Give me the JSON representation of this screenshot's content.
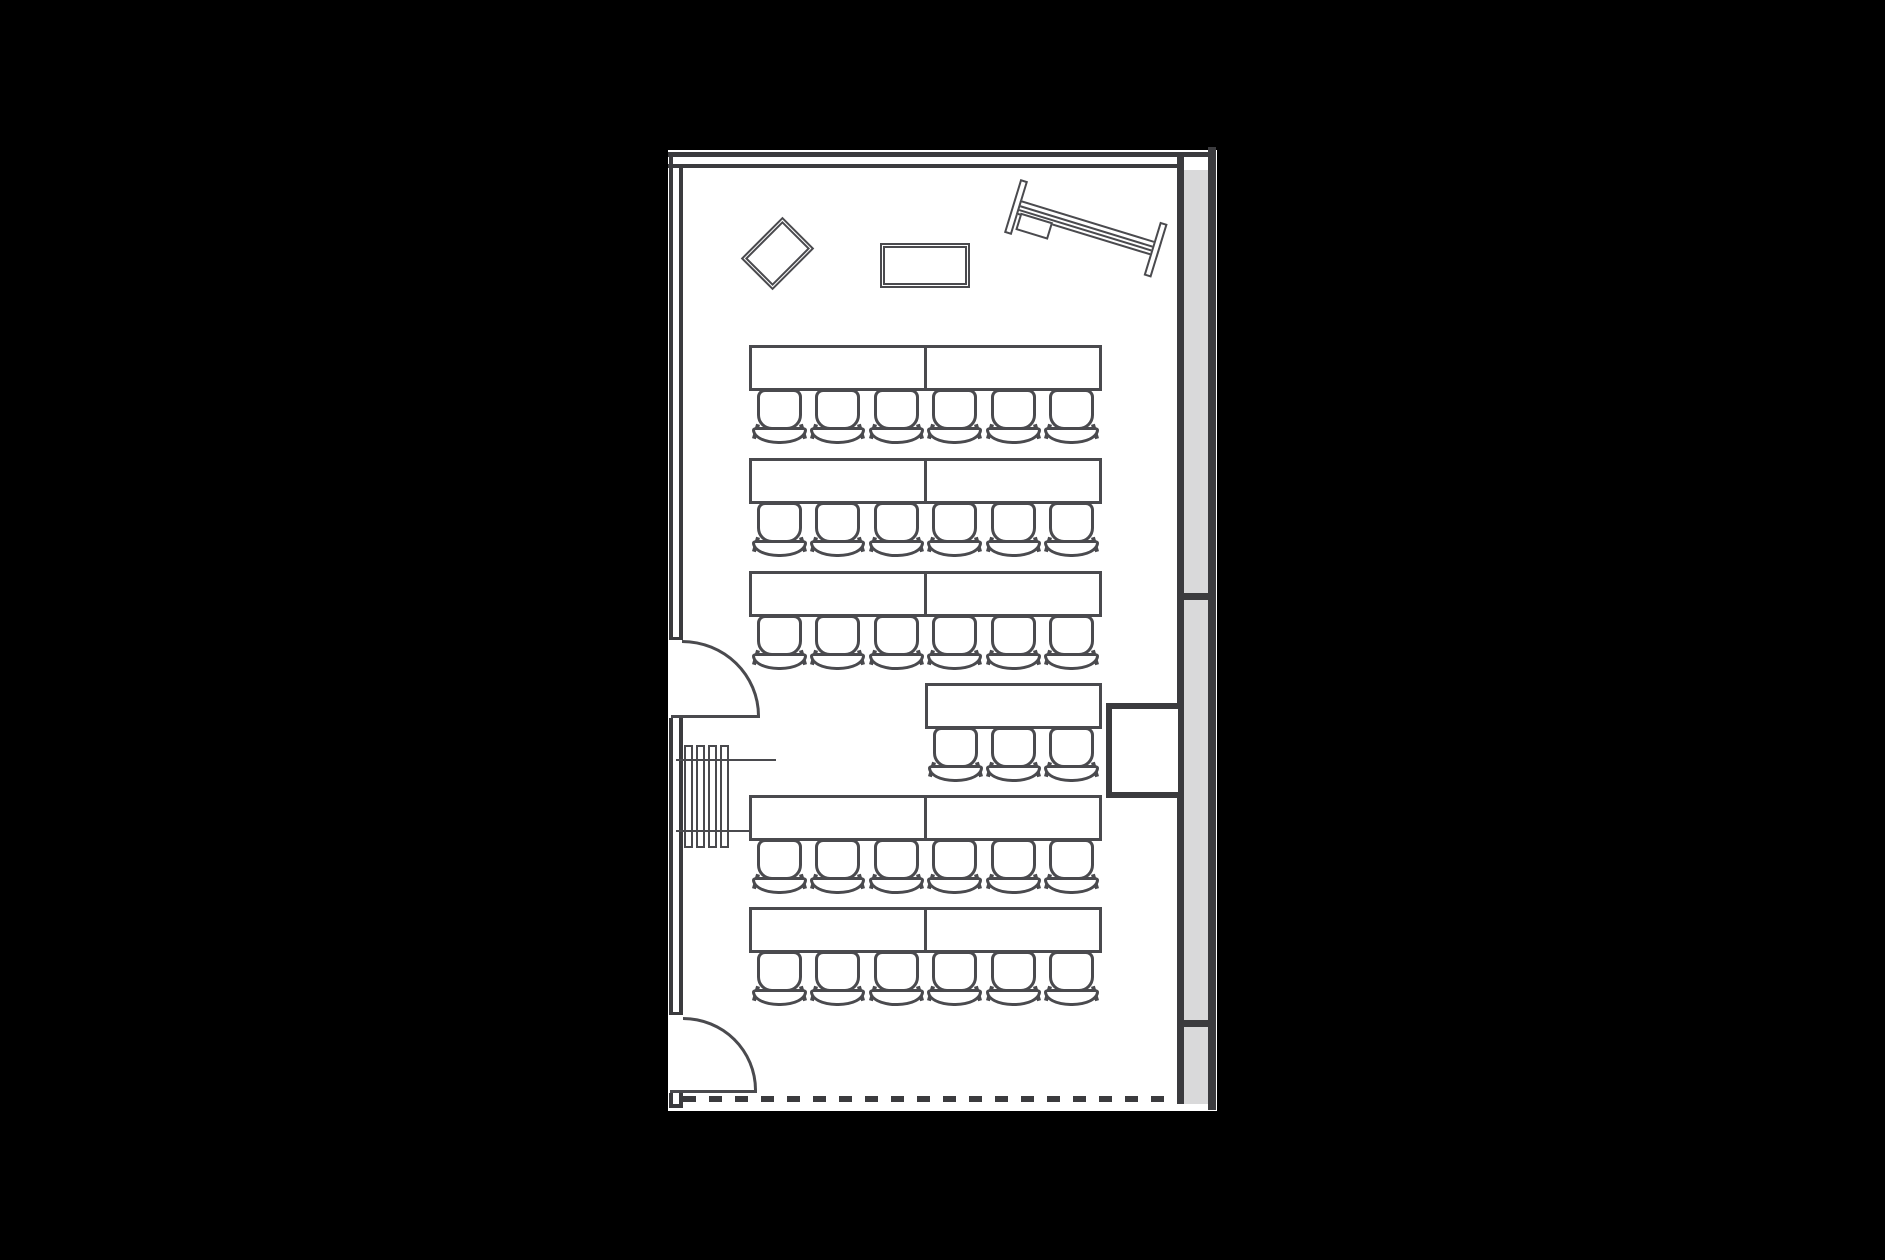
{
  "scene": {
    "kind": "architectural-floor-plan",
    "room": "classroom-lecture-room",
    "background_color": "#000000",
    "floor_color": "#ffffff"
  },
  "palette": {
    "wall_line": "#3b3b3e",
    "furniture_line": "#4a4a4e",
    "exterior_wall_fill": "#d9d9da"
  },
  "seating": {
    "rows": [
      {
        "y": 345,
        "desks": 2,
        "chairs": 6
      },
      {
        "y": 458,
        "desks": 2,
        "chairs": 6
      },
      {
        "y": 571,
        "desks": 2,
        "chairs": 6
      },
      {
        "y": 683,
        "desks": 1,
        "chairs": 3,
        "align": "right"
      },
      {
        "y": 795,
        "desks": 2,
        "chairs": 6
      },
      {
        "y": 907,
        "desks": 2,
        "chairs": 6
      }
    ],
    "total_desk_units": 11,
    "total_chairs": 33
  },
  "fixtures": {
    "doors": [
      {
        "side": "left",
        "position": "middle",
        "symbol": "quarter-arc-swing"
      },
      {
        "side": "left",
        "position": "bottom",
        "symbol": "quarter-arc-swing"
      }
    ],
    "radiator": {
      "slats": 4
    },
    "projection_screen": {
      "rotation_deg": 17,
      "rails": 2
    },
    "rotated_table": {
      "rotation_deg": -45
    },
    "side_table": {
      "shape": "rectangle"
    },
    "lectern_box": {
      "attached_to": "right-wall"
    },
    "bottom_boundary": "dashed-open-edge",
    "right_wall_segments": 3
  }
}
